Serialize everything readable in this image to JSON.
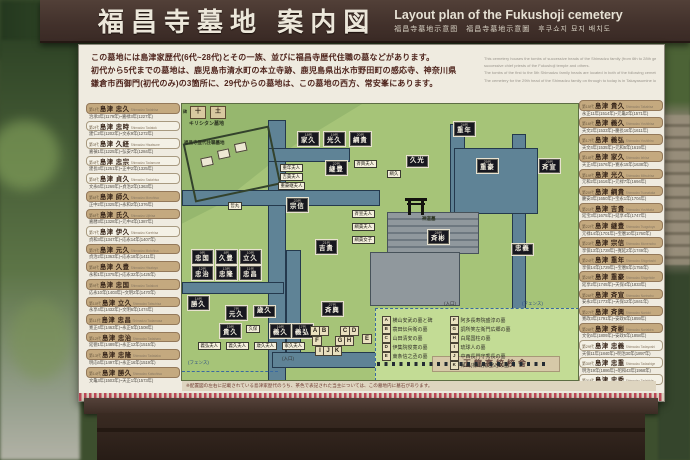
{
  "header": {
    "title_jp": "福昌寺墓地 案内図",
    "title_en": "Layout plan of the Fukushoji cemetery",
    "subtitle": "福昌寺墓地示意图　福昌寺墓地示意圖　후쿠쇼지 묘지 배치도"
  },
  "intro": {
    "jp_lines": [
      "この墓地には島津家歴代(6代~28代)とその一族、並びに福昌寺歴代住職の墓などがあります。",
      "初代から5代までの墓地は、鹿児島市清水町の本立寺跡、鹿児島県出水市野田町の感応寺、神奈川県",
      "鎌倉市西御門(初代のみ)の3箇所に、29代からの墓地は、この墓地の西方、常安峯にあります。"
    ],
    "en_lines": [
      "This cemetery houses the tombs of successive heads of the Shimadzu family (from 6th to 28th generation) and their families along with",
      "successive chief priests of the Fukushoji temple and others.",
      "The tombs of the first to the 5th Shimadzu family heads are located in both of the following cemeteries: on the site of Honryuji in Shimizu-cho, Kagoshima City and at Kannoji in Noda-cho, Izumi City, Kagoshima Prefecture. The first family head is also dedicated at Nishi-gomon, Kamakura City, Kanagawa Prefecture.",
      "The cemetery for the 29th head of the Shimadzu family on through to today is in Takayasumine located to the west of this cemetery."
    ]
  },
  "note": "※配置図の左右に記載されている島津家歴代のうち、茶色で表記された当主については、この墓地内に墓石があります。",
  "columns": {
    "left": [
      {
        "gen": "第1代",
        "name": "島津 忠久",
        "romaji": "Shimadzu Tadahisa",
        "dates": "治承3年(1179年)~嘉禄3年(1227年)",
        "here": true
      },
      {
        "gen": "第2代",
        "name": "島津 忠時",
        "romaji": "Shimadzu Tadatoki",
        "dates": "建仁2年(1202年)~文永9年(1272年)",
        "here": false
      },
      {
        "gen": "第3代",
        "name": "島津 久経",
        "romaji": "Shimadzu Hisatsune",
        "dates": "嘉禎1年(1225年)~弘安7年(1284年)",
        "here": false
      },
      {
        "gen": "第4代",
        "name": "島津 忠宗",
        "romaji": "Shimadzu Tadamune",
        "dates": "建長3年(1251年)~正中2年(1325年)",
        "here": false
      },
      {
        "gen": "第5代",
        "name": "島津 貞久",
        "romaji": "Shimadzu Sadahisa",
        "dates": "文永6年(1269年)~貞治2年(1363年)",
        "here": false
      },
      {
        "gen": "第6代",
        "name": "島津 師久",
        "romaji": "Shimadzu Morohisa",
        "dates": "正中2年(1325年)~永和2年(1376年)",
        "here": true
      },
      {
        "gen": "第6代",
        "name": "島津 氏久",
        "romaji": "Shimadzu Ujihisa",
        "dates": "嘉暦3年(1328年)~元中4年(1387年)",
        "here": true
      },
      {
        "gen": "第7代",
        "name": "島津 伊久",
        "romaji": "Shimadzu Korehisa",
        "dates": "貞和3年(1347年)~応永14年(1407年)",
        "here": false
      },
      {
        "gen": "第7代",
        "name": "島津 元久",
        "romaji": "Shimadzu Motohisa",
        "dates": "貞治2年(1363年)~応永18年(1411年)",
        "here": true
      },
      {
        "gen": "第8代",
        "name": "島津 久豊",
        "romaji": "Shimadzu Hisatoyo",
        "dates": "永和1年(1375年)~応永32年(1425年)",
        "here": true
      },
      {
        "gen": "第9代",
        "name": "島津 忠国",
        "romaji": "Shimadzu Tadakuni",
        "dates": "応永10年(1403年)~文明2年(1470年)",
        "here": true
      },
      {
        "gen": "第10代",
        "name": "島津 立久",
        "romaji": "Shimadzu Tatsuhisa",
        "dates": "永享4年(1432年)~文明6年(1474年)",
        "here": true
      },
      {
        "gen": "第11代",
        "name": "島津 忠昌",
        "romaji": "Shimadzu Tadamasa",
        "dates": "寛正4年(1463年)~永正5年(1508年)",
        "here": true
      },
      {
        "gen": "第12代",
        "name": "島津 忠治",
        "romaji": "Shimadzu Tadaharu",
        "dates": "延徳1年(1489年)~永正12年(1515年)",
        "here": true
      },
      {
        "gen": "第13代",
        "name": "島津 忠隆",
        "romaji": "Shimadzu Tadataka",
        "dates": "明応6年(1497年)~永正16年(1519年)",
        "here": true
      },
      {
        "gen": "第14代",
        "name": "島津 勝久",
        "romaji": "Shimadzu Katsuhisa",
        "dates": "文亀3年(1503年)~天正1年(1573年)",
        "here": true
      }
    ],
    "right": [
      {
        "gen": "第15代",
        "name": "島津 貴久",
        "romaji": "Shimadzu Takahisa",
        "dates": "永正11年(1514年)~元亀2年(1571年)",
        "here": true
      },
      {
        "gen": "第16代",
        "name": "島津 義久",
        "romaji": "Shimadzu Yoshihisa",
        "dates": "天文2年(1533年)~慶長16年(1611年)",
        "here": true
      },
      {
        "gen": "第17代",
        "name": "島津 義弘",
        "romaji": "Shimadzu Yoshihiro",
        "dates": "天文4年(1535年)~元和5年(1619年)",
        "here": true
      },
      {
        "gen": "第18代",
        "name": "島津 家久",
        "romaji": "Shimadzu Iehisa",
        "dates": "天正4年(1576年)~寛永15年(1638年)",
        "here": true
      },
      {
        "gen": "第19代",
        "name": "島津 光久",
        "romaji": "Shimadzu Mitsuhisa",
        "dates": "元和2年(1616年)~元禄7年(1694年)",
        "here": true
      },
      {
        "gen": "第20代",
        "name": "島津 綱貴",
        "romaji": "Shimadzu Tsunataka",
        "dates": "慶安3年(1650年)~宝永1年(1704年)",
        "here": true
      },
      {
        "gen": "第21代",
        "name": "島津 吉貴",
        "romaji": "Shimadzu Yoshitaka",
        "dates": "延宝3年(1675年)~延享4年(1747年)",
        "here": true
      },
      {
        "gen": "第22代",
        "name": "島津 継豊",
        "romaji": "Shimadzu Tsugutoyo",
        "dates": "元禄14年(1701年)~宝暦10年(1760年)",
        "here": true
      },
      {
        "gen": "第23代",
        "name": "島津 宗信",
        "romaji": "Shimadzu Munenobu",
        "dates": "享保13年(1728年)~寛延2年(1749年)",
        "here": true
      },
      {
        "gen": "第24代",
        "name": "島津 重年",
        "romaji": "Shimadzu Shigetoshi",
        "dates": "享保14年(1729年)~宝暦5年(1755年)",
        "here": true
      },
      {
        "gen": "第25代",
        "name": "島津 重豪",
        "romaji": "Shimadzu Shigehide",
        "dates": "延享2年(1745年)~天保4年(1833年)",
        "here": true
      },
      {
        "gen": "第26代",
        "name": "島津 斉宣",
        "romaji": "Shimadzu Narinobu",
        "dates": "安永2年(1773年)~天保12年(1841年)",
        "here": true
      },
      {
        "gen": "第27代",
        "name": "島津 斉興",
        "romaji": "Shimadzu Narioki",
        "dates": "寛政3年(1791年)~安政6年(1859年)",
        "here": true
      },
      {
        "gen": "第28代",
        "name": "島津 斉彬",
        "romaji": "Shimadzu Nariakira",
        "dates": "文化6年(1809年)~安政5年(1858年)",
        "here": true
      },
      {
        "gen": "第29代",
        "name": "島津 忠義",
        "romaji": "Shimadzu Tadayoshi",
        "dates": "天保11年(1840年)~明治30年(1897年)",
        "here": false
      },
      {
        "gen": "第30代",
        "name": "島津 忠重",
        "romaji": "Shimadzu Tadashige",
        "dates": "明治19年(1886年)~昭和43年(1968年)",
        "here": false
      },
      {
        "gen": "第31代",
        "name": "島津 忠秀",
        "romaji": "Shimadzu Tadahide",
        "dates": "大正1年(1912年)~平成8年(1996年)",
        "here": false
      }
    ]
  },
  "map": {
    "labels": {
      "kirishitan": "キリシタン墓地",
      "hi": "碑",
      "cross1": "十",
      "cross2": "土",
      "priests": "福昌寺歴代住職墓地",
      "shinto": "神道墓",
      "entrance": "(入口)",
      "fence": "(フェンス)",
      "school": "玉龍高校校舎"
    },
    "lords": [
      {
        "gen": "18代",
        "name": "家久",
        "x": 116,
        "y": 28
      },
      {
        "gen": "19代",
        "name": "光久",
        "x": 142,
        "y": 28
      },
      {
        "gen": "20代",
        "name": "綱貴",
        "x": 168,
        "y": 28
      },
      {
        "gen": "22代",
        "name": "継豊",
        "x": 144,
        "y": 57
      },
      {
        "gen": "23代",
        "name": "宗信",
        "x": 105,
        "y": 94
      },
      {
        "gen": "21代",
        "name": "吉貴",
        "x": 134,
        "y": 136
      },
      {
        "gen": "24代",
        "name": "重年",
        "x": 272,
        "y": 18
      },
      {
        "gen": "",
        "name": "久光",
        "x": 225,
        "y": 52
      },
      {
        "gen": "25代",
        "name": "重豪",
        "x": 295,
        "y": 55
      },
      {
        "gen": "26代",
        "name": "斉宣",
        "x": 357,
        "y": 55
      },
      {
        "gen": "28代",
        "name": "斉彬",
        "x": 246,
        "y": 126
      },
      {
        "gen": "27代",
        "name": "斉興",
        "x": 140,
        "y": 198
      },
      {
        "gen": "",
        "name": "忠義",
        "x": 330,
        "y": 140
      },
      {
        "gen": "9代",
        "name": "忠国",
        "x": 10,
        "y": 146
      },
      {
        "gen": "8代",
        "name": "久豊",
        "x": 34,
        "y": 146
      },
      {
        "gen": "10代",
        "name": "立久",
        "x": 58,
        "y": 146
      },
      {
        "gen": "12代",
        "name": "忠治",
        "x": 10,
        "y": 162
      },
      {
        "gen": "13代",
        "name": "忠隆",
        "x": 34,
        "y": 162
      },
      {
        "gen": "11代",
        "name": "忠昌",
        "x": 58,
        "y": 162
      },
      {
        "gen": "14代",
        "name": "勝久",
        "x": 6,
        "y": 192
      },
      {
        "gen": "7代",
        "name": "元久",
        "x": 44,
        "y": 202
      },
      {
        "gen": "",
        "name": "歳久",
        "x": 72,
        "y": 202
      },
      {
        "gen": "15代",
        "name": "貴久",
        "x": 38,
        "y": 220
      },
      {
        "gen": "16代",
        "name": "義久",
        "x": 88,
        "y": 220
      },
      {
        "gen": "17代",
        "name": "義弘",
        "x": 110,
        "y": 220
      }
    ],
    "consorts": [
      {
        "name": "哲丸",
        "x": 46,
        "y": 98
      },
      {
        "name": "重年夫人",
        "x": 98,
        "y": 60
      },
      {
        "name": "吉貴夫人",
        "x": 98,
        "y": 69
      },
      {
        "name": "重豪継夫人",
        "x": 96,
        "y": 78
      },
      {
        "name": "斉興夫人",
        "x": 172,
        "y": 56
      },
      {
        "name": "綱久",
        "x": 205,
        "y": 66
      },
      {
        "name": "斉宣夫人",
        "x": 170,
        "y": 106
      },
      {
        "name": "綱貴夫人",
        "x": 170,
        "y": 119
      },
      {
        "name": "綱貴女子",
        "x": 170,
        "y": 132
      },
      {
        "name": "久保",
        "x": 64,
        "y": 221
      },
      {
        "name": "義弘夫人",
        "x": 16,
        "y": 238
      },
      {
        "name": "義久夫人",
        "x": 44,
        "y": 238
      },
      {
        "name": "歳久夫人",
        "x": 72,
        "y": 238
      },
      {
        "name": "家久夫人",
        "x": 100,
        "y": 238
      }
    ],
    "letters": [
      {
        "key": "A",
        "x": 128,
        "y": 222
      },
      {
        "key": "B",
        "x": 137,
        "y": 222
      },
      {
        "key": "C",
        "x": 158,
        "y": 222
      },
      {
        "key": "D",
        "x": 167,
        "y": 222
      },
      {
        "key": "E",
        "x": 180,
        "y": 230
      },
      {
        "key": "F",
        "x": 130,
        "y": 232
      },
      {
        "key": "G",
        "x": 153,
        "y": 232
      },
      {
        "key": "H",
        "x": 162,
        "y": 232
      },
      {
        "key": "I",
        "x": 133,
        "y": 242
      },
      {
        "key": "J",
        "x": 141,
        "y": 242
      },
      {
        "key": "K",
        "x": 150,
        "y": 242
      }
    ],
    "legend": [
      {
        "key": "A",
        "text": "横山安武の墓と碑"
      },
      {
        "key": "B",
        "text": "蓑田伝兵衛の墓"
      },
      {
        "key": "C",
        "text": "山田清安の墓"
      },
      {
        "key": "D",
        "text": "伊集院俊寛の墓"
      },
      {
        "key": "E",
        "text": "東条信之丞の墓"
      },
      {
        "key": "F",
        "text": "阿多長寿院盛淳の墓"
      },
      {
        "key": "G",
        "text": "調所笑左衛門広郷の墓"
      },
      {
        "key": "H",
        "text": "白尾国柱の墓"
      },
      {
        "key": "I",
        "text": "琉球人の墓"
      },
      {
        "key": "J",
        "text": "中西長門守秀長の墓"
      },
      {
        "key": "K",
        "text": "帰山(樺山資之父)の墓"
      }
    ]
  },
  "colors": {
    "header_bg": "#42312b",
    "sign_bg": "#efebe0",
    "map_green": "#a6c478",
    "highlight_tan": "#c4a97f",
    "path_blue": "#5f8396",
    "black_box": "#17171f",
    "red_strip": "#bb4757"
  }
}
